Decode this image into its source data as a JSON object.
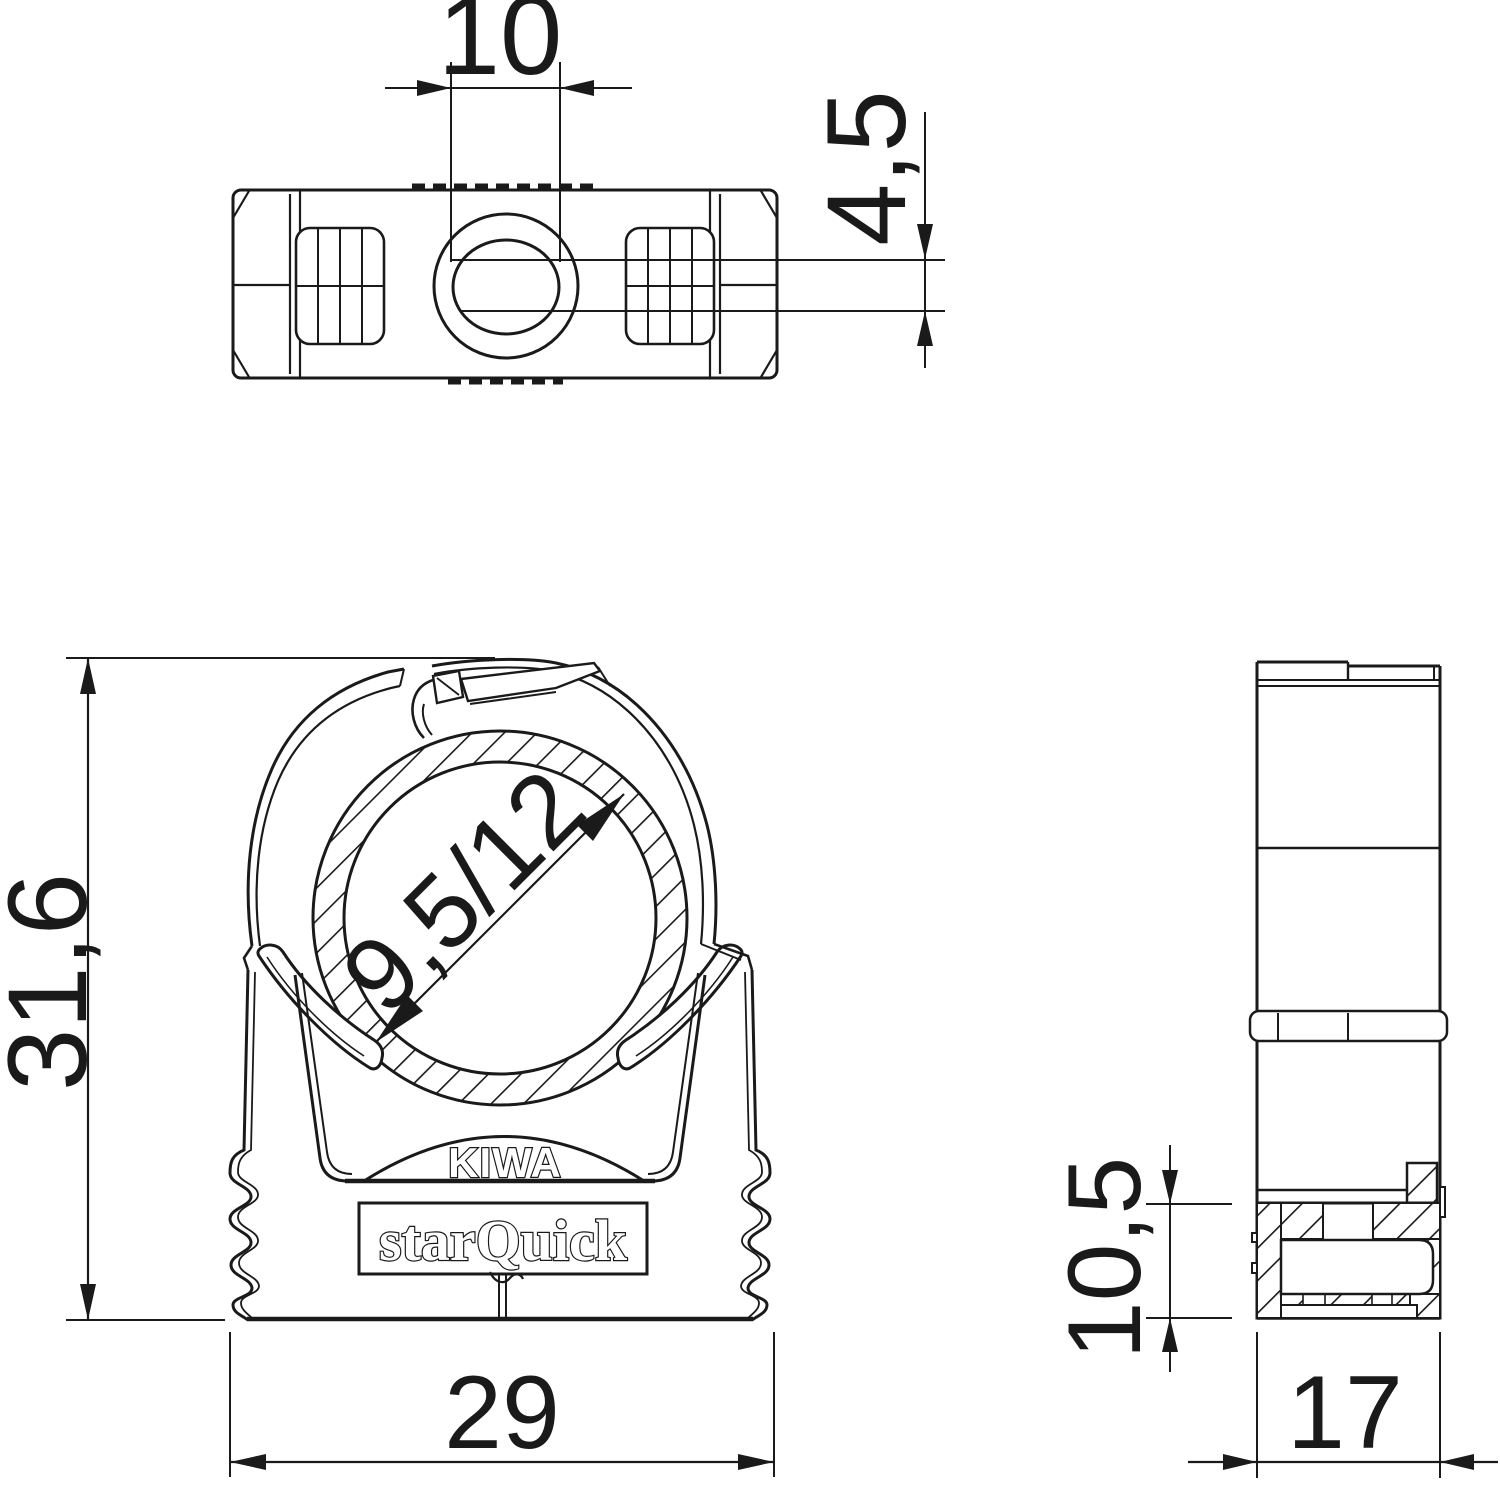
{
  "page": {
    "background": "#ffffff",
    "line_color": "#1a1a1a"
  },
  "drawing": {
    "type": "technical-drawing",
    "views": {
      "top_view": {
        "name": "top view",
        "dim_width": "10",
        "dim_height": "4,5"
      },
      "front_view": {
        "name": "front view",
        "dim_height": "31,6",
        "dim_width": "29",
        "dim_pipe": "9,5/12",
        "marking_cert": "KIWA",
        "marking_brand": "starQuick"
      },
      "side_view": {
        "name": "side view",
        "dim_foot": "10,5",
        "dim_depth": "17"
      }
    }
  }
}
